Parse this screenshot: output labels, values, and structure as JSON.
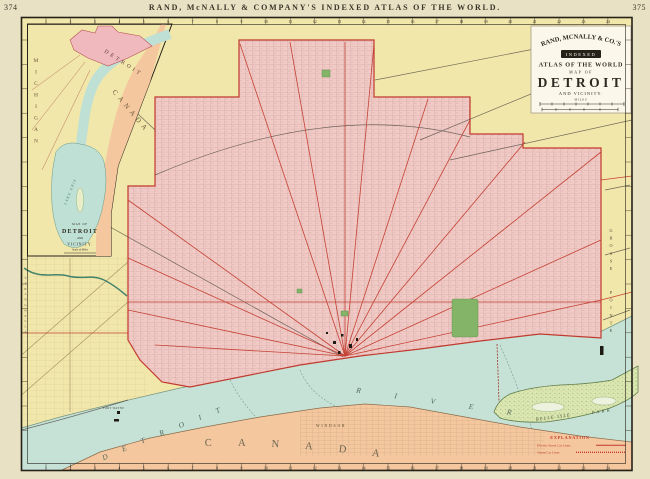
{
  "header": {
    "page_left": "374",
    "page_right": "375",
    "title": "RAND, McNALLY & COMPANY'S INDEXED ATLAS OF THE WORLD."
  },
  "cartouche": {
    "publisher": "RAND, MCNALLY & CO.'S",
    "series": "INDEXED",
    "atlas": "ATLAS OF THE WORLD",
    "map_of": "MAP OF",
    "title": "DETROIT",
    "subtitle": "AND VICINITY.",
    "scale_units": "MILES"
  },
  "inset": {
    "michigan": "MICHIGAN",
    "detroit": "DETROIT",
    "canada": "CANADA",
    "lake": "LAKE ERIE",
    "title_map_of": "MAP OF",
    "title": "DETROIT",
    "title_and": "AND",
    "title_vicinity": "VICINITY.",
    "scale_note": "Scale of Miles"
  },
  "labels": {
    "river_word_1": "DETROIT",
    "river_word_2": "RIVER",
    "canada": "CANADA",
    "windsor": "WINDSOR",
    "grosse": "GROSSE",
    "pointe": "POINTE",
    "springwells": "SPRINGWELLS",
    "fort_wayne": "FORT WAYNE",
    "belle_isle": "BELLE ISLE",
    "park": "PARK"
  },
  "legend": {
    "title": "EXPLANATION",
    "items": [
      {
        "label": "Electric Street Car Lines",
        "line": "solid"
      },
      {
        "label": "Steam Car Lines",
        "line": "hatched"
      }
    ]
  },
  "border_grid": {
    "numbers": [
      1,
      2,
      3,
      4,
      5,
      6,
      7,
      8,
      9,
      10,
      11,
      12,
      13,
      14,
      15,
      16,
      17,
      18,
      19,
      20,
      21,
      22,
      23,
      24
    ]
  },
  "colors": {
    "paper": "#e9e1c3",
    "map_yellow": "#f2e7aa",
    "city_pink": "#f1cac6",
    "canada_peach": "#f4c79e",
    "river_teal": "#c6e2d6",
    "island_green": "#dbe6b0",
    "park_green": "#83b468",
    "boundary_red": "#c0392e",
    "legend_red": "#c03a2e",
    "frame_black": "#26221a",
    "cartouche_bg": "#fbf7ea"
  }
}
